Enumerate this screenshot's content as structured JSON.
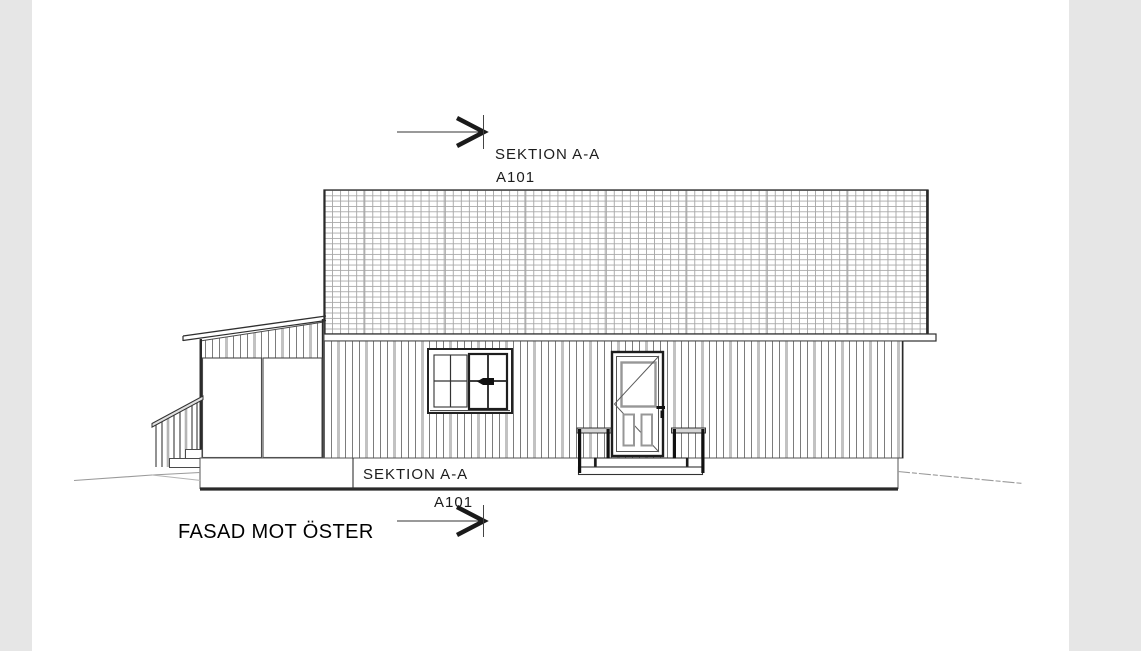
{
  "drawing": {
    "title": "FASAD MOT ÖSTER",
    "section_marker_top": {
      "label": "SEKTION A-A",
      "sheet": "A101"
    },
    "section_marker_bottom": {
      "label": "SEKTION A-A",
      "sheet": "A101"
    }
  },
  "icons": {
    "section_arrow_top": "section-arrow-right-icon",
    "section_arrow_bottom": "section-arrow-right-icon"
  },
  "colors": {
    "canvas": "#ffffff",
    "margin": "#e6e6e6",
    "line_dark": "#2a2a2a",
    "line_medium": "#6e6e6e",
    "line_light": "#c2c2c2",
    "roof_grid": "#a6a6a6",
    "ground": "#9a9a9a",
    "door_panel_frame": "#979797"
  }
}
